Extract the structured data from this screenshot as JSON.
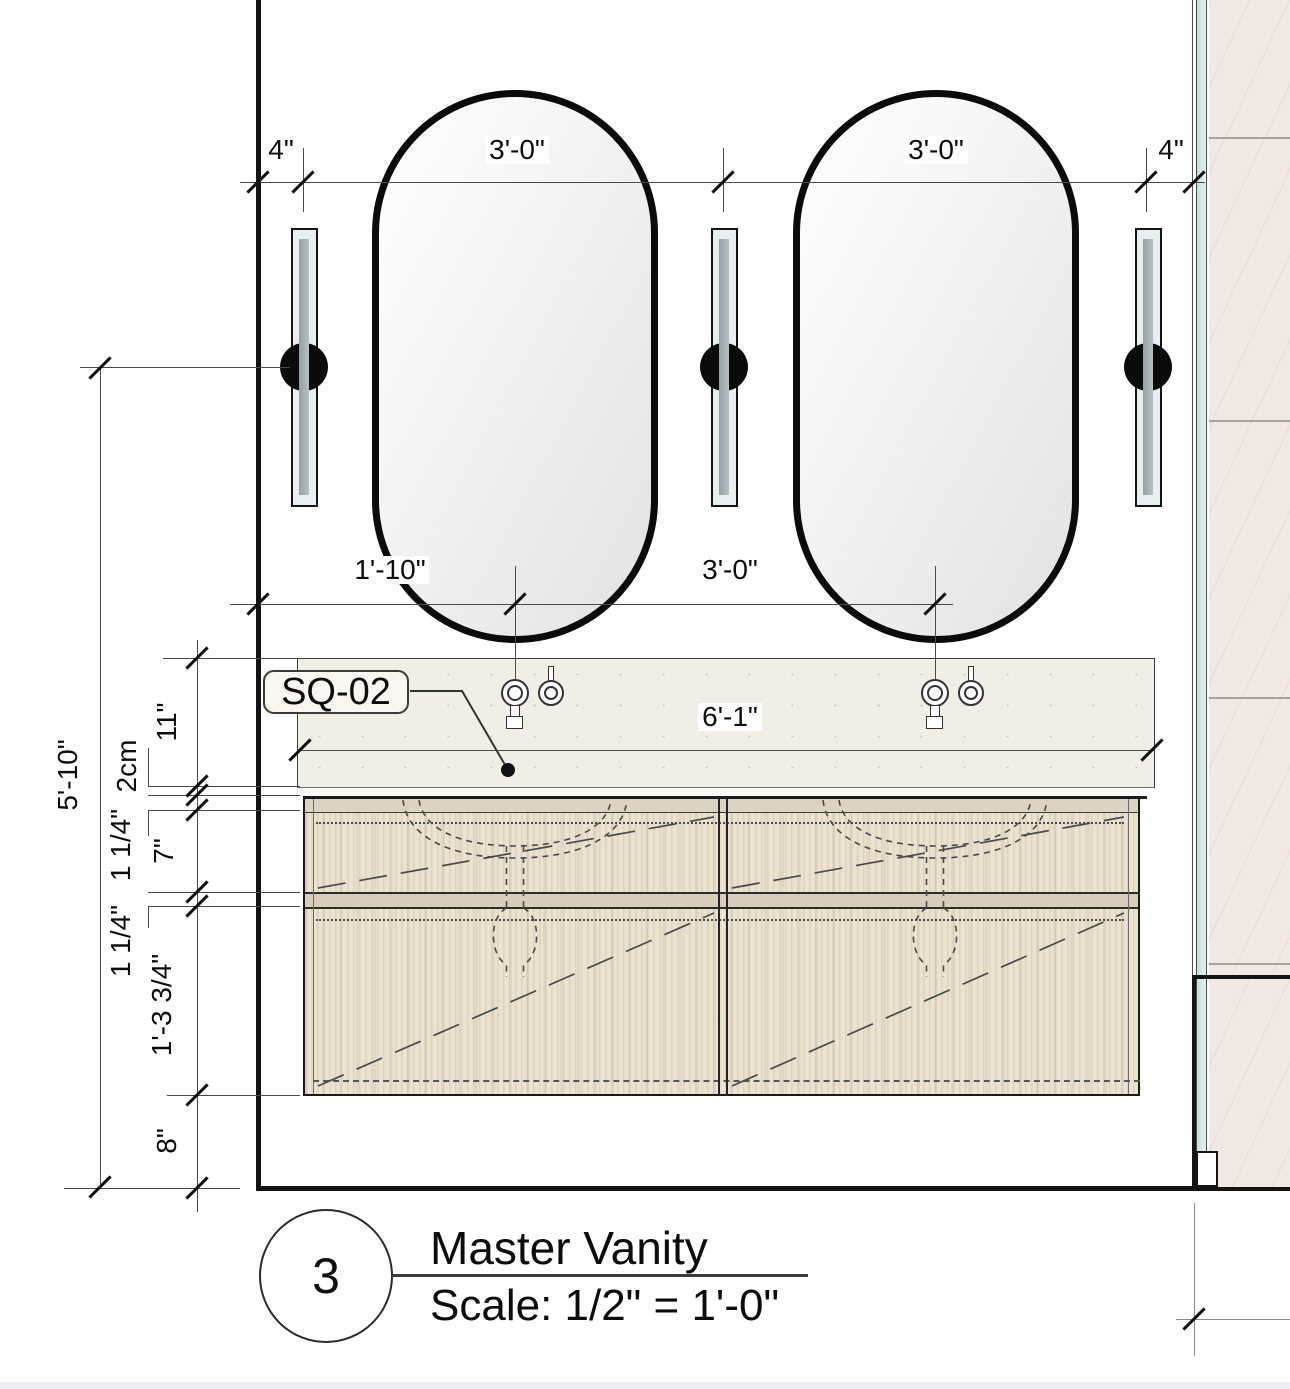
{
  "drawing": {
    "dims": {
      "top": [
        "4\"",
        "3'-0\"",
        "3'-0\"",
        "4\""
      ],
      "mid": [
        "1'-10\"",
        "3'-0\""
      ],
      "counter": "6'-1\"",
      "overall": "5'-10\"",
      "chain": [
        "11\"",
        "2cm",
        "1 1/4\"",
        "7\"",
        "1 1/4\"",
        "1'-3 3/4\"",
        "8\""
      ]
    },
    "callout": {
      "tag": "SQ-02"
    },
    "titleblock": {
      "number": "3",
      "title": "Master Vanity",
      "scale": "Scale: 1/2\" = 1'-0\""
    },
    "colors": {
      "counter": "#f0eee5",
      "wood": "#ebe2d0",
      "tile": "#f2e9e2",
      "glass_edge": "#d4e7e4",
      "line": "#141414"
    }
  }
}
